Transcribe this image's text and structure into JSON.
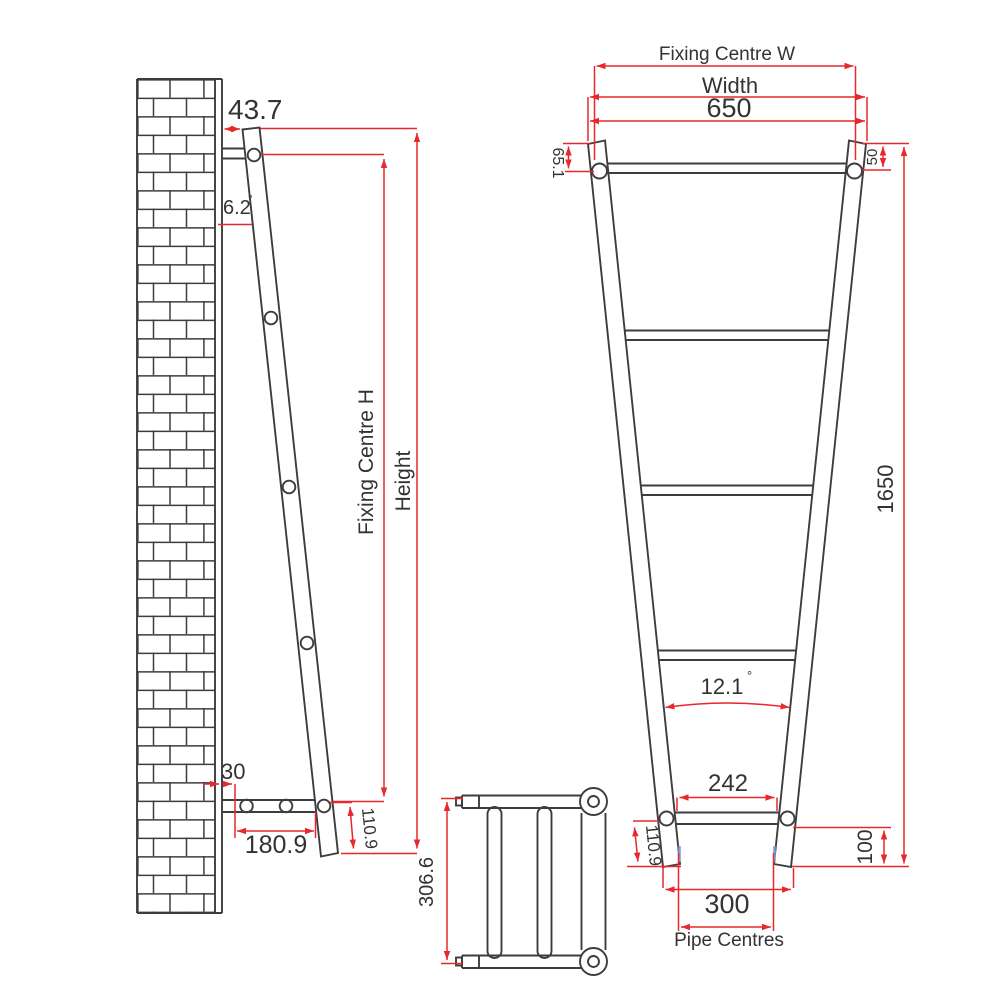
{
  "drawing": {
    "side_view": {
      "wall_offset": "43.7",
      "lean_angle": "6.2",
      "degree": "°",
      "bracket_wall_gap": "30",
      "bracket_length": "180.9",
      "foot_length": "110.9",
      "fixing_centre_h_label": "Fixing Centre H",
      "height_label": "Height"
    },
    "plan_view": {
      "depth": "306.6"
    },
    "front_view": {
      "fixing_centre_w_label": "Fixing Centre W",
      "width_label": "Width",
      "width_value": "650",
      "left_fixing_offset": "65.1",
      "right_fixing_offset": "50",
      "height_value": "1650",
      "taper_angle": "12.1",
      "degree": "°",
      "bottom_inner_width": "242",
      "left_foot_length": "110.9",
      "right_foot_offset": "100",
      "pipe_centres_value": "300",
      "pipe_centres_label": "Pipe Centres"
    },
    "colors": {
      "line": "#3d3d3d",
      "dimension": "#e8282c",
      "text": "#333333",
      "pipe_mark": "#7d9be0"
    }
  }
}
